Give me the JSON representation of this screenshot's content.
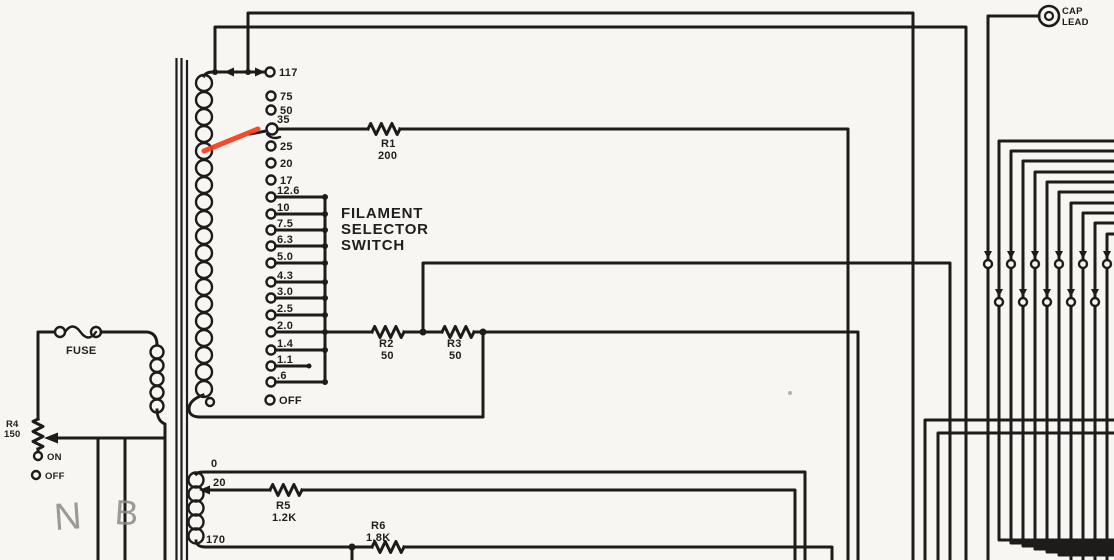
{
  "meta": {
    "kind": "scanned schematic diagram",
    "paper_color": "#f7f6f2",
    "ink_color": "#1d1c1a",
    "highlight_color": "#f63b1c",
    "pencil_color": "#8d8b86"
  },
  "filament_switch": {
    "label_lines": [
      "FILAMENT",
      "SELECTOR",
      "SWITCH"
    ],
    "taps": [
      "117",
      "75",
      "50",
      "35",
      "25",
      "20",
      "17",
      "12.6",
      "10",
      "7.5",
      "6.3",
      "5.0",
      "4.3",
      "3.0",
      "2.5",
      "2.0",
      "1.4",
      "1.1",
      ".6",
      "OFF"
    ],
    "selected_tap": "35"
  },
  "resistors": {
    "r1": {
      "name": "R1",
      "value": "200"
    },
    "r2": {
      "name": "R2",
      "value": "50"
    },
    "r3": {
      "name": "R3",
      "value": "50"
    },
    "r5": {
      "name": "R5",
      "value": "1.2K"
    },
    "r6": {
      "name": "R6",
      "value": "1.8K"
    }
  },
  "primary_side": {
    "fuse_label": "FUSE",
    "rheostat": {
      "name": "R4",
      "value": "150"
    },
    "switch_on": "ON",
    "switch_off": "OFF"
  },
  "secondary_winding": {
    "taps": [
      "0",
      "20",
      "170"
    ]
  },
  "cap_lead": {
    "lines": [
      "CAP",
      "LEAD"
    ]
  },
  "pencil_notes": [
    "N",
    "B"
  ]
}
